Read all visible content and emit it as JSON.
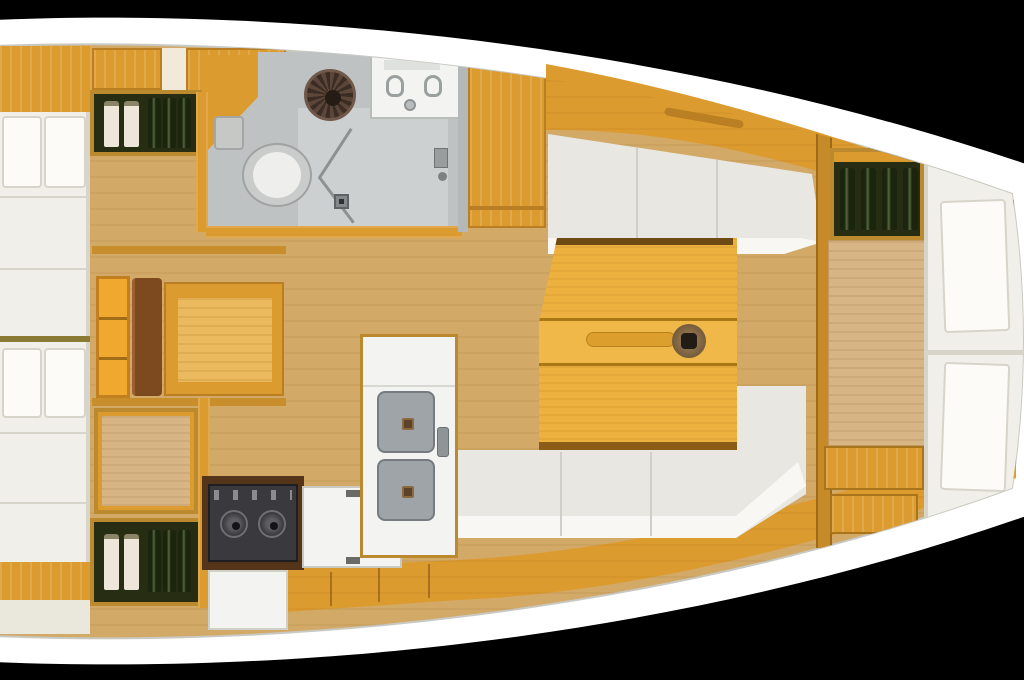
{
  "scene": {
    "subject": "sailboat-interior-floor-plan",
    "view": "top-down",
    "orientation": "bow-right",
    "background": "black"
  },
  "fixtures": {
    "aft_cabin_berths": 2,
    "forward_v_berth_cushions": 2,
    "salon_table_leaves": 2,
    "table_cup_holders": 1,
    "galley_sinks": 2,
    "stove_burners": 2,
    "head_toilets": 1,
    "head_sink_faucets": 2,
    "bottle_lockers": 3,
    "bottles_total": 14
  },
  "colors": {
    "background": "#000000",
    "hull": "#ffffff",
    "hull-line": "#c9c9c4",
    "wood": "#dc9b2f",
    "wood-dark": "#b97f22",
    "wood-deep": "#54351a",
    "wood-frame": "#bb8a2e",
    "wood-light": "#ecba5e",
    "floor": "#d2a967",
    "floor-panel": "#d8b584",
    "table": "#ecb13e",
    "table-light": "#f0b848",
    "table-seam": "#a97714",
    "table-trim": "#6e4a14",
    "cushion": "#f1efe9",
    "cushion-bright": "#fcfbf8",
    "cushion-seam": "#d7d4ca",
    "bench": "#e8e7e1",
    "bench-highlight": "#f8f7f3",
    "gray-floor": "#bfc2c3",
    "gray-panel": "#cdd0d0",
    "gray-line": "#8e9192",
    "white-fixture": "#f3f3f1",
    "stove": "#3a3a3e",
    "stove-detail": "#8b8b90",
    "sink": "#9fa4a8",
    "sink-edge": "#767b7f",
    "drain": "#5c422a",
    "bottle-green": "#1b250e",
    "bottle-light": "#ece7d8",
    "locker-bg": "#262d13",
    "seat-brown": "#7c4a1e",
    "olive-divider": "#8b7a33",
    "hatch-dark": "#3b2d23",
    "hatch-mid": "#5c463a"
  }
}
